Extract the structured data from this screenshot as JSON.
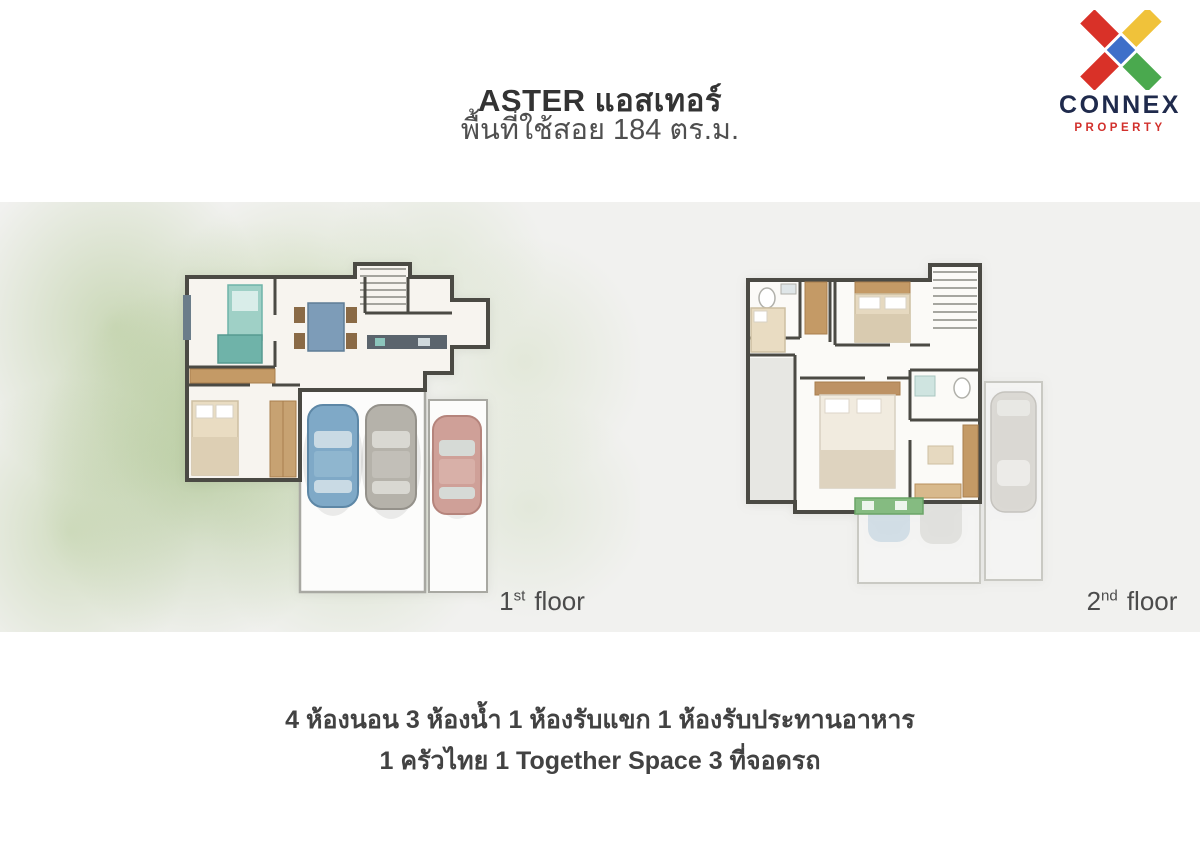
{
  "header": {
    "title": "ASTER แอสเทอร์",
    "subtitle": "พื้นที่ใช้สอย 184 ตร.ม."
  },
  "logo": {
    "name": "CONNEX",
    "tagline": "PROPERTY",
    "icon": "connex-x-icon",
    "colors": {
      "red": "#d93128",
      "yellow": "#f0c23a",
      "green": "#4aa94e",
      "blue": "#3e6fc9",
      "navy": "#1f2a4c",
      "tagline_red": "#d2302c"
    }
  },
  "plans": [
    {
      "label": {
        "number": "1",
        "suffix": "st",
        "word": "floor"
      }
    },
    {
      "label": {
        "number": "2",
        "suffix": "nd",
        "word": "floor"
      }
    }
  ],
  "summary": {
    "line1": "4 ห้องนอน 3 ห้องน้ำ 1 ห้องรับแขก 1 ห้องรับประทานอาหาร",
    "line2": "1 ครัวไทย 1 Together Space  3 ที่จอดรถ"
  },
  "palette": {
    "page_background": "#ffffff",
    "band_background": "#f1f1ef",
    "wall": "#4b4a44",
    "wood": "#c49a66",
    "teal": "#8cc5bc",
    "car_blue": "#7fa9c7",
    "car_gray": "#b5b2aa",
    "car_red": "#cfa098",
    "bench_green": "#85bb81"
  }
}
